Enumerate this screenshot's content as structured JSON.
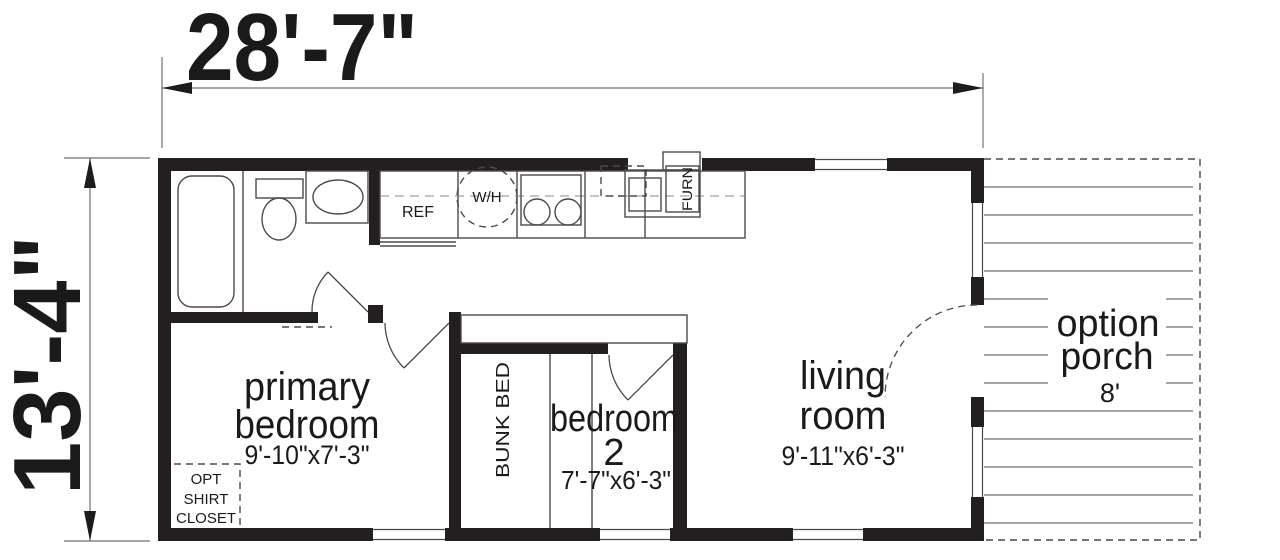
{
  "dimensions": {
    "width_label": "28'-7\"",
    "height_label": "13'-4\""
  },
  "rooms": {
    "primary_bedroom": {
      "line1": "primary",
      "line2": "bedroom",
      "size": "9'-10\"x7'-3\""
    },
    "bedroom_2": {
      "line1": "bedroom",
      "line2": "2",
      "size": "7'-7\"x6'-3\""
    },
    "living_room": {
      "line1": "living",
      "line2": "room",
      "size": "9'-11\"x6'-3\""
    },
    "porch": {
      "line1": "option",
      "line2": "porch",
      "size": "8'"
    }
  },
  "fixtures": {
    "refrigerator": "REF",
    "water_heater": "W/H",
    "furnace": "FURN",
    "bunk_bed": "BUNK BED",
    "closet": {
      "line1": "OPT",
      "line2": "SHIRT",
      "line3": "CLOSET"
    }
  },
  "colors": {
    "wall": "#231f20",
    "line": "#4a4a4a",
    "dim": "#707070",
    "background": "#ffffff"
  }
}
